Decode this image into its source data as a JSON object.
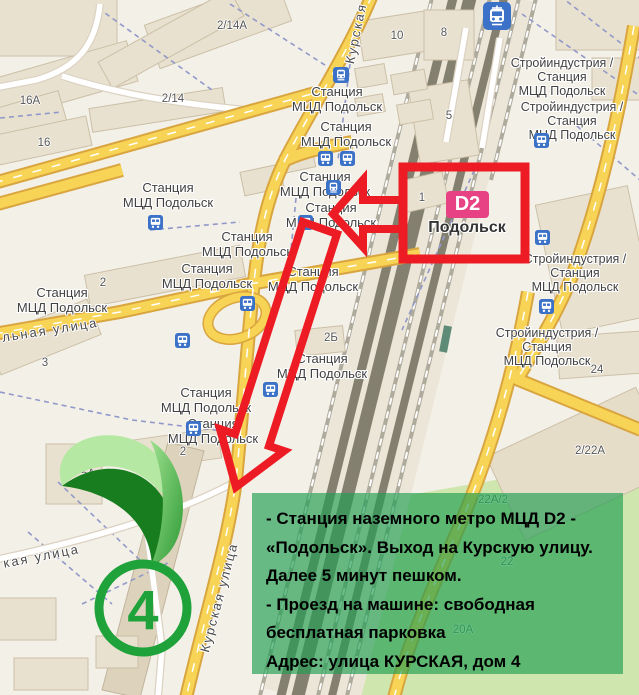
{
  "map": {
    "station_label": {
      "line1": "Станция",
      "line2": "МЦД Подольск"
    },
    "stroyindustria_label": {
      "line1": "Стройиндустрия /",
      "line2": "Станция",
      "line3": "МЦД Подольск"
    },
    "streets": {
      "kurskaya": "Курская",
      "kurskaya_ulitsa": "Курская улица",
      "lnaya_ulitsa": "льная улица",
      "kaya_ulitsa": "кая улица"
    },
    "buildings": {
      "b2_14a": "2/14A",
      "b2_14": "2/14",
      "b16a": "16А",
      "b16": "16",
      "b10": "10",
      "b8": "8",
      "b5": "5",
      "b1": "1",
      "b2b": "2Б",
      "b2": "2",
      "b3": "3",
      "b5a": "5А",
      "b24": "24",
      "b2_22a": "2/22А",
      "b22a_2": "22А/2",
      "b22": "22",
      "b20a": "20А"
    },
    "icons": {
      "bus": "bus-icon",
      "train": "train-icon",
      "tram": "tram-icon"
    }
  },
  "annotations": {
    "d2_badge": {
      "label": "D2",
      "station_name": "Подольск",
      "color": "#e74283"
    },
    "marker": {
      "number": "4",
      "color": "#1fa23a"
    },
    "arrows": {
      "color": "#ed1c24"
    },
    "note": {
      "background": "#209e52",
      "lines": [
        "- Станция наземного метро МЦД D2 -",
        "«Подольск». Выход на Курскую улицу.",
        "Далее 5 минут пешком.",
        "- Проезд на машине: свободная",
        "бесплатная парковка",
        "Адрес: улица КУРСКАЯ, дом 4"
      ]
    }
  },
  "colors": {
    "land": "#f3f0e8",
    "road_yellow": "#f8d456",
    "road_casing": "#d9a53f",
    "building": "#e9e1cf",
    "rail": "#84806f",
    "park": "#cfe7ae",
    "transit_blue": "#3b72c8",
    "path_dash": "#9299c9"
  }
}
